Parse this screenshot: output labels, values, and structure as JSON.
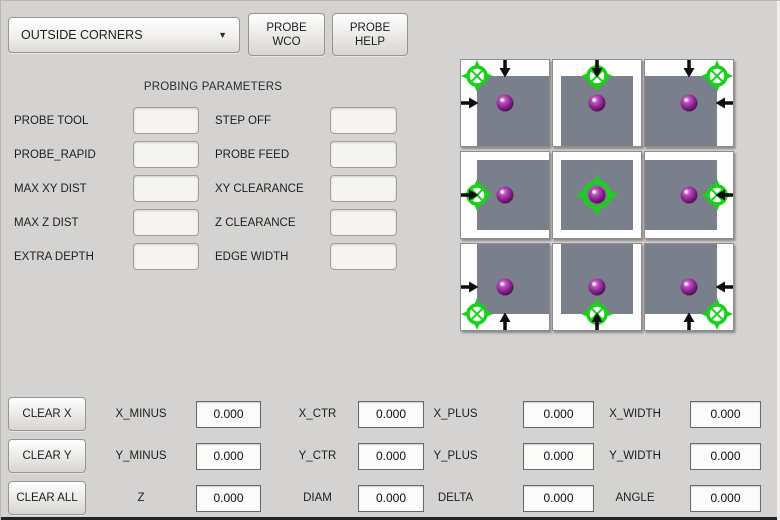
{
  "toolbar": {
    "mode_dropdown": {
      "value": "OUTSIDE CORNERS"
    },
    "probe_wco_button": {
      "line1": "PROBE",
      "line2": "WCO"
    },
    "probe_help_button": {
      "line1": "PROBE",
      "line2": "HELP"
    }
  },
  "parameters": {
    "title": "PROBING PARAMETERS",
    "rows": [
      {
        "left_label": "PROBE TOOL",
        "left_value": "",
        "right_label": "STEP OFF",
        "right_value": ""
      },
      {
        "left_label": "PROBE_RAPID",
        "left_value": "",
        "right_label": "PROBE FEED",
        "right_value": ""
      },
      {
        "left_label": "MAX XY DIST",
        "left_value": "",
        "right_label": "XY CLEARANCE",
        "right_value": ""
      },
      {
        "left_label": "MAX Z DIST",
        "left_value": "",
        "right_label": "Z CLEARANCE",
        "right_value": ""
      },
      {
        "left_label": "EXTRA DEPTH",
        "left_value": "",
        "right_label": "EDGE WIDTH",
        "right_value": ""
      }
    ]
  },
  "probe_grid": {
    "colors": {
      "tile_bg": "#fdfdfd",
      "square": "#79808b",
      "marker_green": "#17d317",
      "arrow": "#0d0d0d",
      "sphere_purple": "#8b2190"
    },
    "tiles": [
      {
        "name": "probe-position-top-left-corner",
        "square": [
          16,
          16
        ],
        "marker": [
          16,
          16
        ],
        "center": false,
        "arrows": [
          "down",
          "right"
        ]
      },
      {
        "name": "probe-position-top-edge",
        "square": [
          8,
          16
        ],
        "marker": [
          44,
          16
        ],
        "center": false,
        "arrows": [
          "down"
        ]
      },
      {
        "name": "probe-position-top-right-corner",
        "square": [
          0,
          16
        ],
        "marker": [
          72,
          16
        ],
        "center": false,
        "arrows": [
          "down",
          "left"
        ]
      },
      {
        "name": "probe-position-left-edge",
        "square": [
          16,
          8
        ],
        "marker": [
          16,
          43
        ],
        "center": false,
        "arrows": [
          "right"
        ]
      },
      {
        "name": "probe-position-center",
        "square": [
          8,
          8
        ],
        "marker": [
          44,
          43
        ],
        "center": true,
        "arrows": []
      },
      {
        "name": "probe-position-right-edge",
        "square": [
          0,
          8
        ],
        "marker": [
          72,
          43
        ],
        "center": false,
        "arrows": [
          "left"
        ]
      },
      {
        "name": "probe-position-bottom-left-corner",
        "square": [
          16,
          0
        ],
        "marker": [
          16,
          70
        ],
        "center": false,
        "arrows": [
          "up",
          "right"
        ]
      },
      {
        "name": "probe-position-bottom-edge",
        "square": [
          8,
          0
        ],
        "marker": [
          44,
          70
        ],
        "center": false,
        "arrows": [
          "up"
        ]
      },
      {
        "name": "probe-position-bottom-right-corner",
        "square": [
          0,
          0
        ],
        "marker": [
          72,
          70
        ],
        "center": false,
        "arrows": [
          "up",
          "left"
        ]
      }
    ]
  },
  "results": {
    "rows": [
      {
        "button": "CLEAR X",
        "fields": [
          {
            "label": "X_MINUS",
            "value": "0.000"
          },
          {
            "label": "X_CTR",
            "value": "0.000"
          },
          {
            "label": "X_PLUS",
            "value": "0.000"
          },
          {
            "label": "X_WIDTH",
            "value": "0.000"
          }
        ]
      },
      {
        "button": "CLEAR Y",
        "fields": [
          {
            "label": "Y_MINUS",
            "value": "0.000"
          },
          {
            "label": "Y_CTR",
            "value": "0.000"
          },
          {
            "label": "Y_PLUS",
            "value": "0.000"
          },
          {
            "label": "Y_WIDTH",
            "value": "0.000"
          }
        ]
      },
      {
        "button": "CLEAR ALL",
        "fields": [
          {
            "label": "Z",
            "value": "0.000"
          },
          {
            "label": "DIAM",
            "value": "0.000"
          },
          {
            "label": "DELTA",
            "value": "0.000"
          },
          {
            "label": "ANGLE",
            "value": "0.000"
          }
        ]
      }
    ]
  }
}
